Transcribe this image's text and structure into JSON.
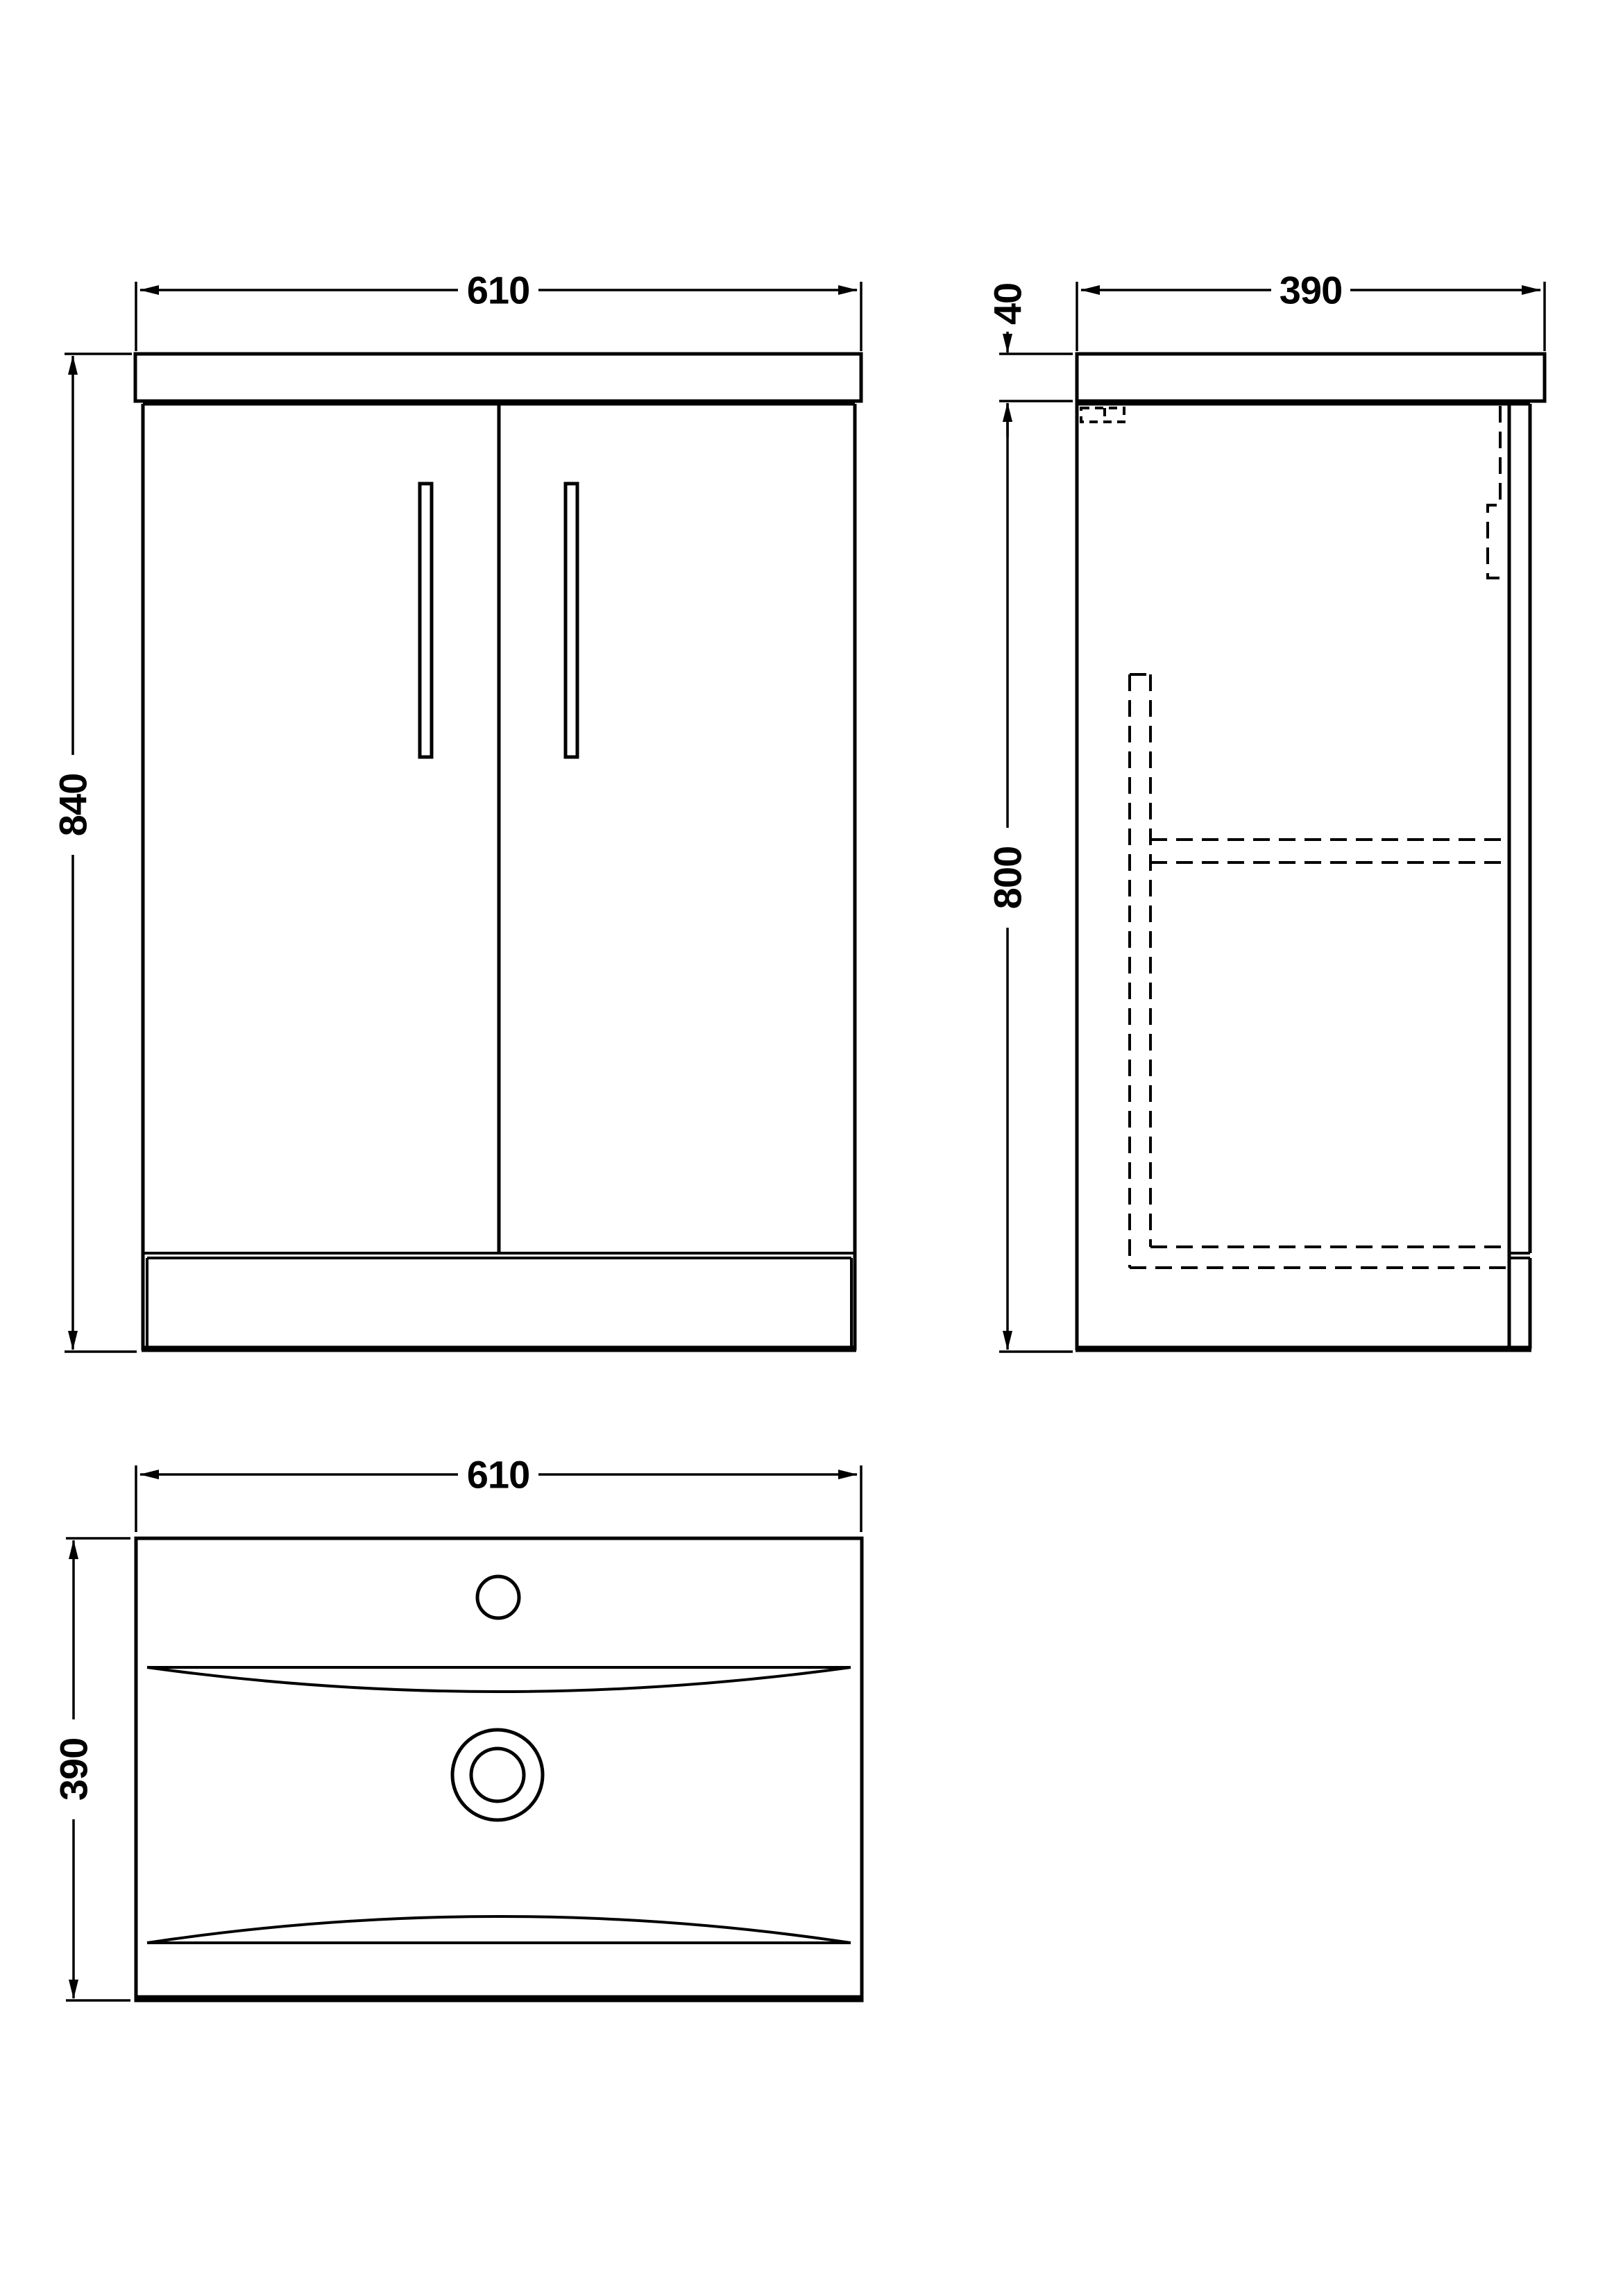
{
  "page": {
    "background_color": "#ffffff",
    "line_color": "#000000",
    "drawing_type": "vanity unit technical drawing"
  },
  "views": {
    "front": {
      "title": "front elevation",
      "dimensions": {
        "width_label": "610",
        "height_label": "840"
      }
    },
    "side": {
      "title": "side elevation",
      "dimensions": {
        "depth_label": "390",
        "worktop_thickness_label": "40",
        "cabinet_height_label": "800"
      }
    },
    "plan": {
      "title": "basin plan",
      "dimensions": {
        "width_label": "610",
        "depth_label": "390"
      }
    }
  }
}
